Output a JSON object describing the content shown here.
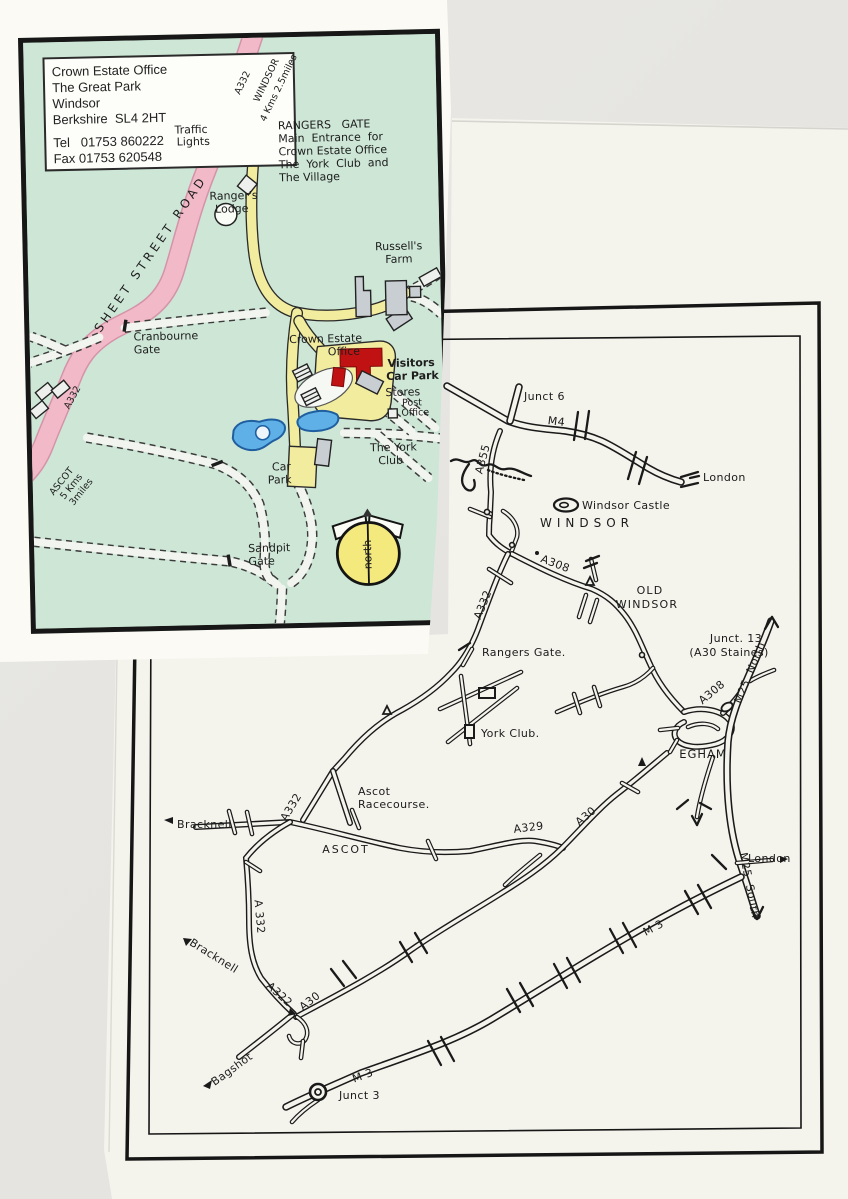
{
  "colors": {
    "scanner_bg": "#e8e7e3",
    "paper": "#f4f3ec",
    "map1_green": "#cde6d6",
    "road_pink": "#f2bac8",
    "road_yellow": "#f2ec9e",
    "pond_blue": "#5fb0e6",
    "office_red": "#c01212",
    "compass_yellow": "#f3e97c",
    "ink": "#1a1a1a"
  },
  "map1": {
    "address": {
      "l1": "Crown Estate Office",
      "l2": "The Great Park",
      "l3": "Windsor",
      "l4": "Berkshire  SL4 2HT",
      "l5": "Tel   01753 860222",
      "l6": "Fax 01753 620548"
    },
    "labels": {
      "a332_top": "A332",
      "windsor_dist": "WINDSOR",
      "windsor_dist2": "4 Kms 2.5miles",
      "traffic1": "Traffic",
      "traffic2": "Lights",
      "rg1": "RANGERS   GATE",
      "rg2": "Main  Entrance  for",
      "rg3": "Crown Estate Office",
      "rg4": "The  York  Club  and",
      "rg5": "The Village",
      "lodge1": "Ranger's",
      "lodge2": "Lodge",
      "sheet": "SHEET STREET ROAD",
      "cran1": "Cranbourne",
      "cran2": "Gate",
      "farm1": "Russell's",
      "farm2": "Farm",
      "ceo1": "Crown Estate",
      "ceo2": "Office",
      "vis1": "Visitors",
      "vis2": "Car Park",
      "stores": "Stores",
      "post1": "Post",
      "post2": "Office",
      "york1": "The York",
      "york2": "Club",
      "car1": "Car",
      "car2": "Park",
      "sand1": "Sandpit",
      "sand2": "Gate",
      "a332_bot": "A332",
      "ascot1": "ASCOT",
      "ascot2": "5 Kms",
      "ascot3": "3miles",
      "north": "north"
    }
  },
  "map2": {
    "labels": {
      "junct6": "Junct 6",
      "m4": "M4",
      "london_m4": "London",
      "a355": "A355",
      "castle": "Windsor Castle",
      "windsor": "WINDSOR",
      "a308a": "A308",
      "oldw1": "OLD",
      "oldw2": "WINDSOR",
      "a332a": "A332",
      "rangers": "Rangers Gate.",
      "junct13a": "Junct. 13",
      "junct13b": "(A30 Staines)",
      "m25n": "M25  North",
      "a308b": "A308",
      "egham": "EGHAM",
      "yorkclub": "York Club.",
      "race1": "Ascot",
      "race2": "Racecourse.",
      "bracknell_w": "Bracknell",
      "a332b": "A332",
      "ascot": "ASCOT",
      "a329": "A329",
      "a30a": "A30",
      "london_m25": "London",
      "m25s": "M25  South",
      "a332c": "A 332",
      "bracknell_s": "Bracknell",
      "a322": "A322",
      "a30b": "A30",
      "bagshot": "Bagshot",
      "m3a": "M 3",
      "m3b": "M 3",
      "junct3": "Junct 3"
    }
  }
}
